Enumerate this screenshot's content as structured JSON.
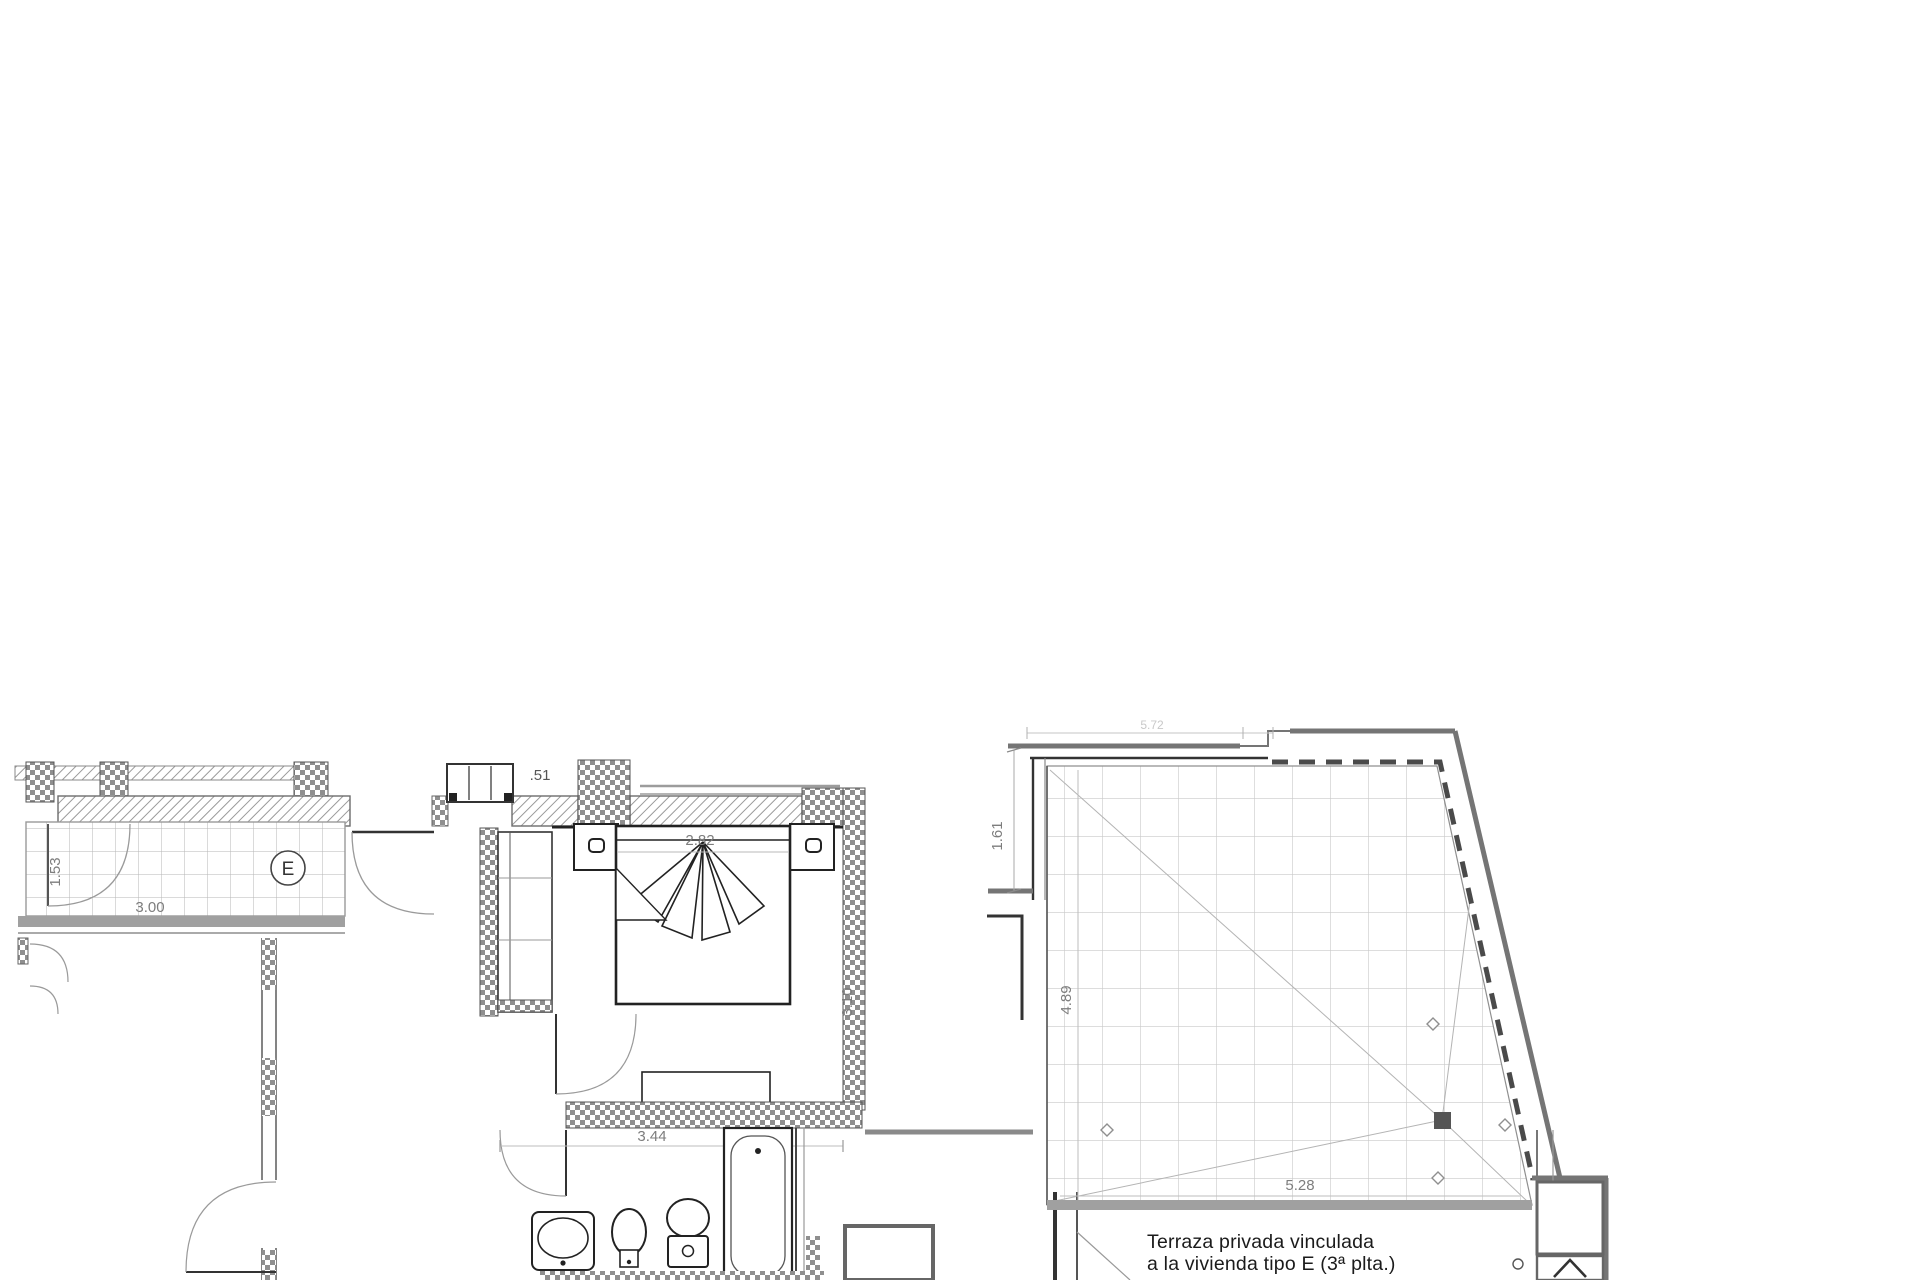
{
  "plan": {
    "type": "architectural-floor-plan",
    "unit": {
      "room_label": "E",
      "level_marker": ".51"
    },
    "left_dimensions": {
      "terrace_depth": "1.53",
      "terrace_width": "3.00",
      "bedroom_width": "2.82",
      "bedroom_depth": "3.10",
      "bathroom_width": "3.44"
    },
    "right_dimensions": {
      "top_faint": "5.72",
      "left_upper": "1.61",
      "left_inner": "4.89",
      "bottom": "5.28"
    },
    "terrace_caption": {
      "line1": "Terraza privada vinculada",
      "line2": "a la vivienda tipo E (3ª plta.)"
    },
    "colors": {
      "wall_gray": "#757575",
      "line_dark": "#2f2f2f",
      "dim_gray": "#8a8a8a",
      "grid_gray": "#cccccc"
    }
  }
}
